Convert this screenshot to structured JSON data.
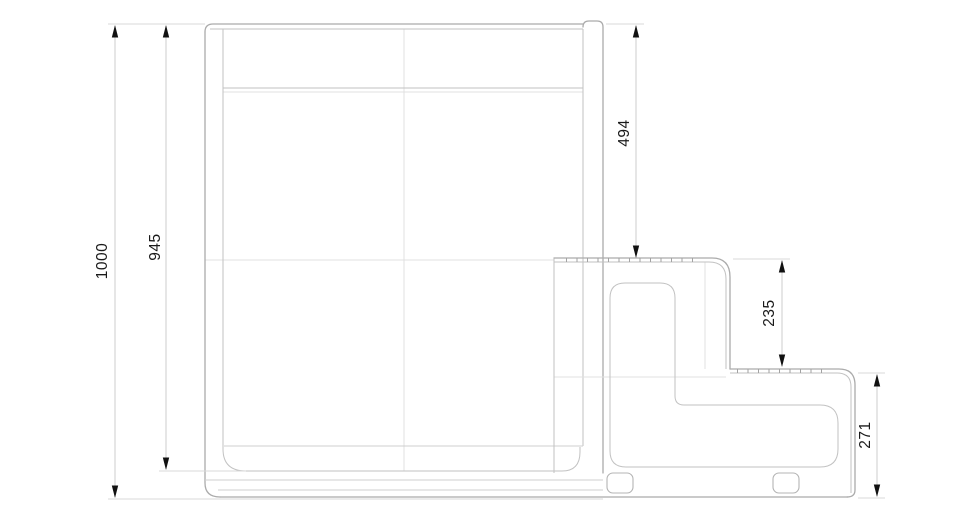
{
  "drawing": {
    "kind": "technical-side-elevation",
    "dimension_labels": {
      "overall_height": "1000",
      "inner_height": "945",
      "upper_section": "494",
      "middle_section": "235",
      "lower_section": "271"
    },
    "colors": {
      "background": "#ffffff",
      "outline": "#ababab",
      "secondary_line": "#c2c2c2",
      "faint_line": "#e0e0e0",
      "dimension_line": "#cdcdcd",
      "arrow": "#111111",
      "label_text": "#1a1a1a"
    }
  }
}
